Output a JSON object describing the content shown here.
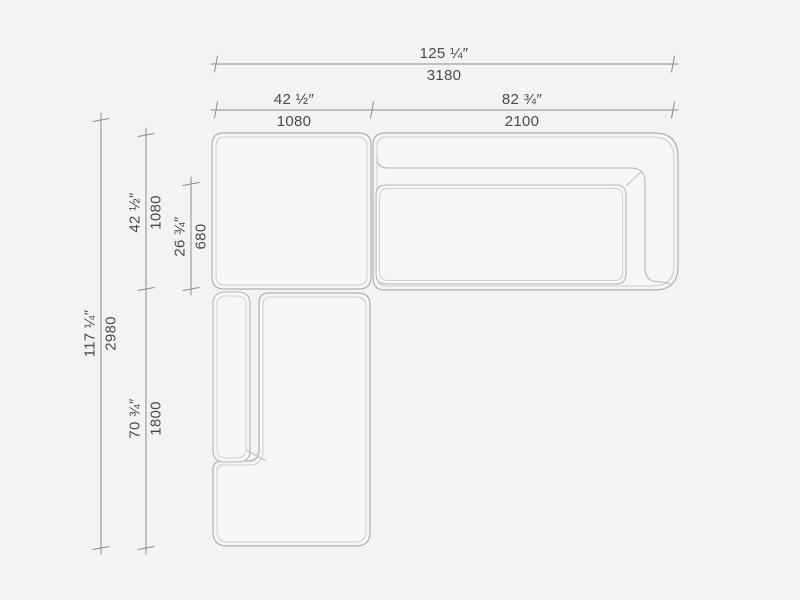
{
  "drawing_type": "sectional-sofa-plan-view",
  "colors": {
    "background": "#f3f3f3",
    "dimension_lines": "#8c8c8c",
    "module_outline": "#b0b0b0",
    "module_inner_outline": "#cdcdcd",
    "cushion_outline": "#b6b6b6",
    "seam_line": "#bfbfbf",
    "label_text": "#4a4a4a"
  },
  "dimensions": {
    "horizontal": [
      {
        "name": "overall-width",
        "inches": "125 ¼″",
        "mm": "3180"
      },
      {
        "name": "corner-module-width",
        "inches": "42 ½″",
        "mm": "1080"
      },
      {
        "name": "sofa-section-width",
        "inches": "82 ¾″",
        "mm": "2100"
      }
    ],
    "vertical": [
      {
        "name": "overall-depth",
        "inches": "117 ¼″",
        "mm": "2980"
      },
      {
        "name": "corner-module-depth",
        "inches": "42 ½″",
        "mm": "1080"
      },
      {
        "name": "seat-depth",
        "inches": "26 ¾″",
        "mm": "680"
      },
      {
        "name": "chaise-section-length",
        "inches": "70 ¾″",
        "mm": "1800"
      }
    ]
  }
}
